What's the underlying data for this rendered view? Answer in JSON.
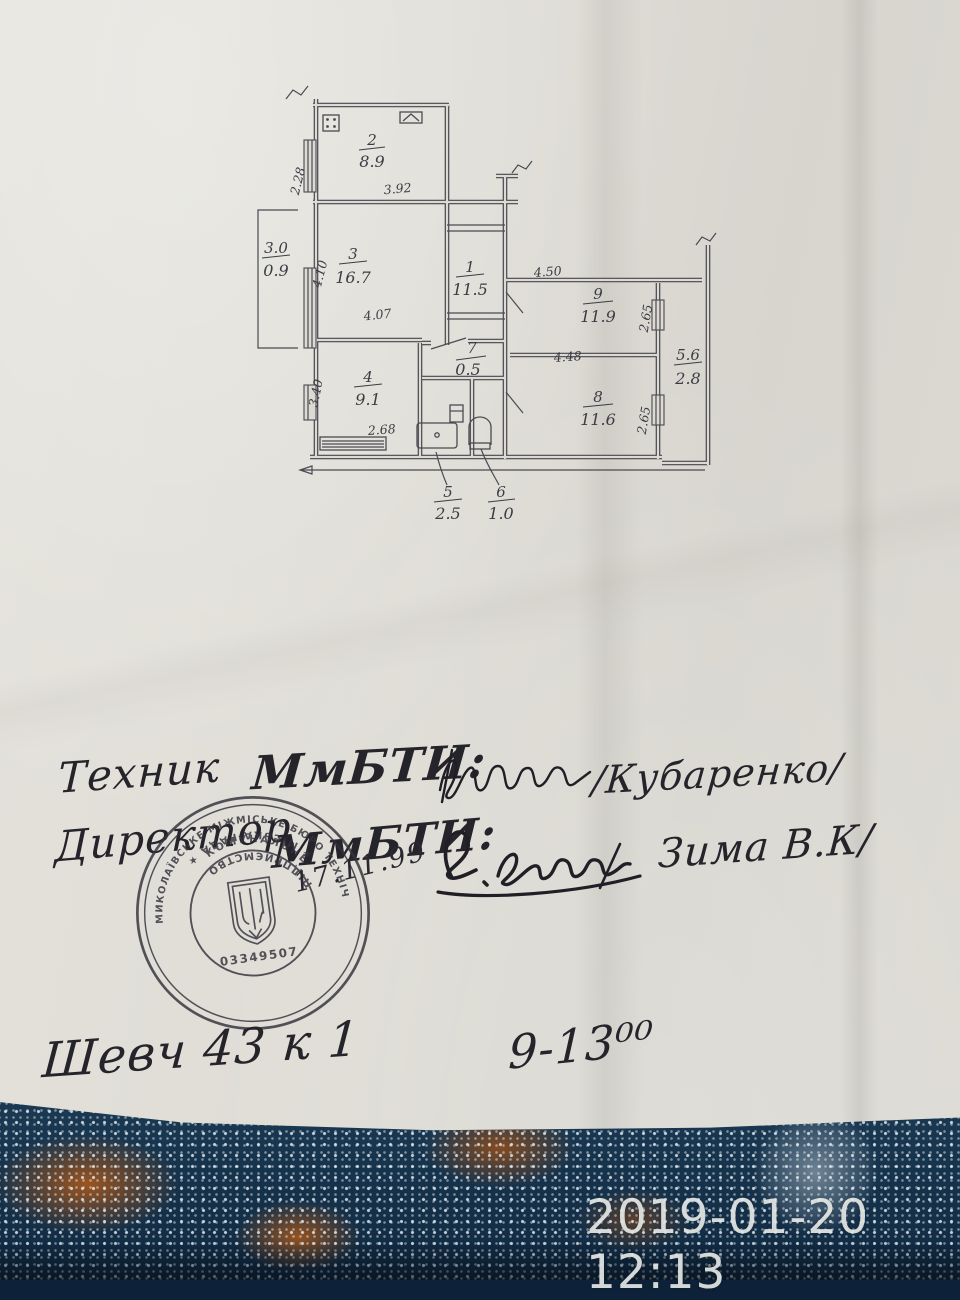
{
  "photo": {
    "timestamp": "2019-01-20 12:13"
  },
  "plan": {
    "rooms": {
      "r1": {
        "num": "1",
        "area": "11.5"
      },
      "r2": {
        "num": "2",
        "area": "8.9"
      },
      "r3": {
        "num": "3",
        "area": "16.7"
      },
      "r4": {
        "num": "4",
        "area": "9.1"
      },
      "r5": {
        "num": "5",
        "area": "2.5"
      },
      "r6": {
        "num": "6",
        "area": "1.0"
      },
      "r7": {
        "num": "7",
        "area": "0.5"
      },
      "r8": {
        "num": "8",
        "area": "11.6"
      },
      "r9": {
        "num": "9",
        "area": "11.9"
      }
    },
    "balconies": {
      "left": {
        "num": "3.0",
        "area": "0.9"
      },
      "right": {
        "num": "5.6",
        "area": "2.8"
      }
    },
    "dims": {
      "room2_left": "2.28",
      "room2_bottom": "3.92",
      "room3_left": "4.10",
      "room3_bottom": "4.07",
      "room4_left": "3.40",
      "room4_bottom": "2.68",
      "room9_top": "4.50",
      "room9_bottom": "4.48",
      "room9_right": "2.65",
      "room8_right": "2.65"
    }
  },
  "handwriting": {
    "line1": {
      "role": "Техник",
      "org": "МмБТИ:",
      "surname": "/Кубаренко/"
    },
    "line2": {
      "role": "Директор",
      "org": "МмБТИ:",
      "surname": "Зима В.К/"
    },
    "stamp_date": "17.11.99",
    "line3": {
      "address": "Шевч 43 к 1",
      "hours": "9-13⁰⁰"
    }
  },
  "stamp": {
    "outer_top": "МИКОЛАЇВСЬКЕ МІЖМІСЬКЕ БЮРО ТЕХНІЧНОЇ ІНВЕНТАРИЗАЦІЇ",
    "outer_bottom": "★ МІСЬКА РАДА ★",
    "inner_top": "КОМУНАЛЬНЕ",
    "inner_bottom": "ПІДПРИЄМСТВО",
    "code": "03349507"
  },
  "colors": {
    "paper": "#dedcd5",
    "ink": "#46464e",
    "carpet": "#14304a",
    "stamp_ink": "#34323b"
  }
}
